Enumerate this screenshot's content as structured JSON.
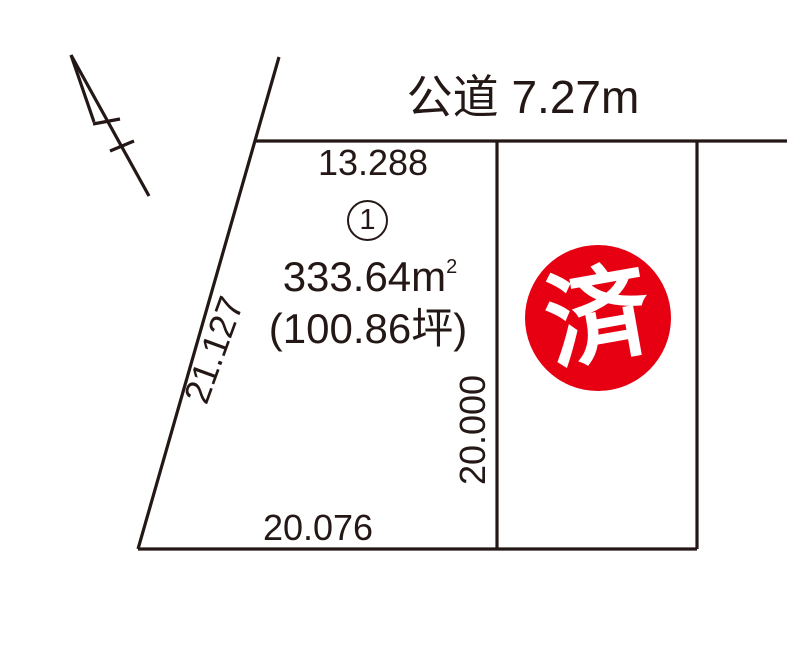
{
  "diagram": {
    "road_label": "公道 7.27m",
    "icons": {
      "north_arrow": "north-arrow-double-tick"
    },
    "lot": {
      "number": "1",
      "area_sqm": "333.64",
      "area_unit": "m",
      "area_exponent": "2",
      "area_tsubo": "(100.86坪)",
      "dim_top": "13.288",
      "dim_left": "21.127",
      "dim_right": "20.000",
      "dim_bottom": "20.076"
    },
    "sold_lot": {
      "status_stamp": "済"
    },
    "colors": {
      "line": "#231815",
      "sold_red": "#e60012",
      "stamp_text": "#ffffff"
    }
  }
}
